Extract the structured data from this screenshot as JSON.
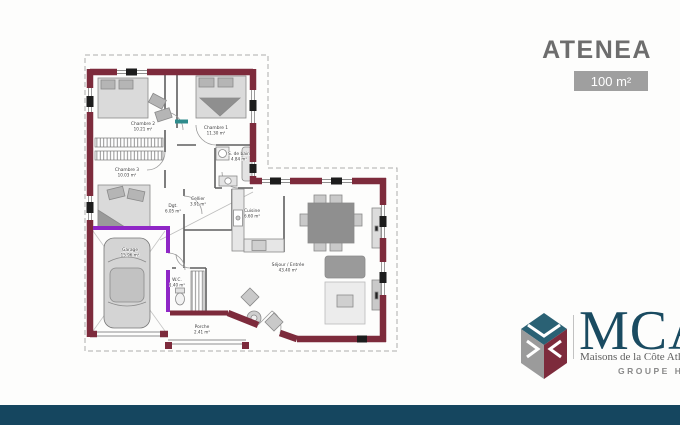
{
  "header": {
    "title": "ATENEA",
    "area_badge": "100 m²"
  },
  "plan": {
    "rooms": [
      {
        "name": "Chambre 2",
        "area": "10.21 m²"
      },
      {
        "name": "Chambre 1",
        "area": "11.30 m²"
      },
      {
        "name": "S. de bain",
        "area": "4.84 m²"
      },
      {
        "name": "Chambre 3",
        "area": "10.03 m²"
      },
      {
        "name": "Garage",
        "area": "15.96 m²"
      },
      {
        "name": "Dgt.",
        "area": "6.05 m²"
      },
      {
        "name": "Cellier",
        "area": "3.91 m²"
      },
      {
        "name": "Cuisine",
        "area": "6.60 m²"
      },
      {
        "name": "W.C.",
        "area": "1.40 m²"
      },
      {
        "name": "Porche",
        "area": "2.41 m²"
      },
      {
        "name": "Séjour / Entrée",
        "area": "43.40 m²"
      }
    ],
    "colors": {
      "wall": "#7d2b3c",
      "accent": "#8f27c6",
      "line": "#8f8f8f"
    }
  },
  "logo": {
    "brand": "MCA",
    "tagline": "Maisons de la Côte Atlantique",
    "group": "GROUPE HEXAOM",
    "colors": {
      "brand": "#1a4b61",
      "teal": "#2a6174",
      "gray": "#9b9b9b",
      "maroon": "#7d2b3c"
    }
  },
  "footer": {
    "bar_color": "#15465f"
  }
}
